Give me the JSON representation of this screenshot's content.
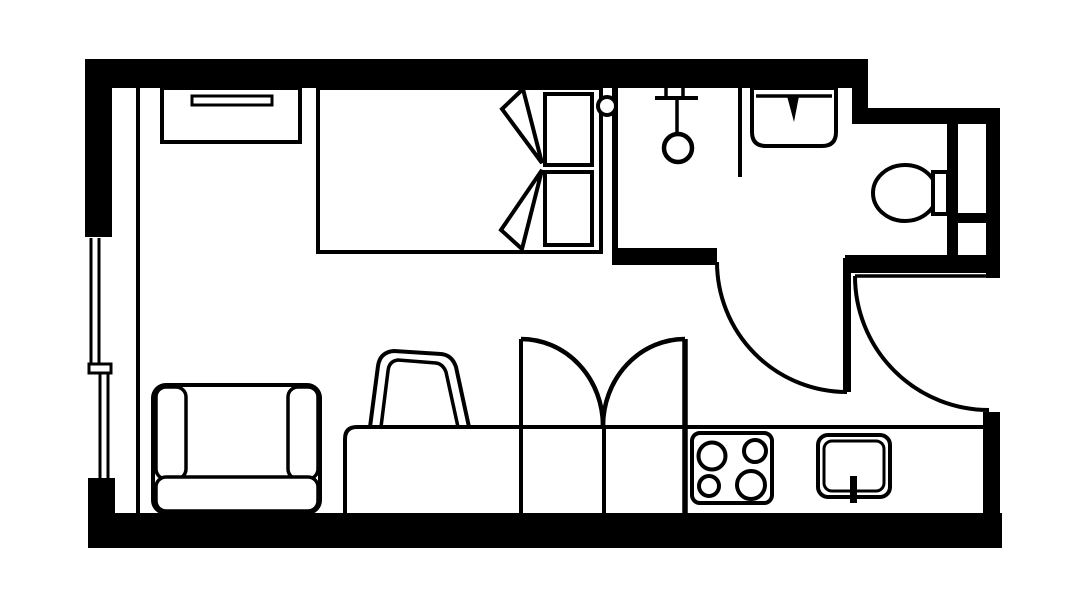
{
  "canvas": {
    "width": 1092,
    "height": 614,
    "viewbox": "0 0 1092 614"
  },
  "colors": {
    "background": "#ffffff",
    "line": "#000000"
  },
  "floor_plan": {
    "kind": "studio-apartment-floor-plan",
    "areas": [
      {
        "name": "sleeping-area",
        "elements": [
          "wardrobe-dresser",
          "dresser-handle",
          "double-bed",
          "pillow",
          "pillow",
          "duvet-fold",
          "duvet-fold",
          "wall-knob"
        ]
      },
      {
        "name": "bathroom",
        "elements": [
          "shower-head",
          "shower-rail",
          "shower-screen",
          "wash-basin",
          "basin-tap",
          "toilet-bowl",
          "toilet-cistern",
          "service-shaft-window",
          "bathroom-door-swing"
        ]
      },
      {
        "name": "living-area",
        "elements": [
          "armchair",
          "tilted-chair",
          "sofa-bench",
          "bench-divider",
          "bench-divider",
          "bench-divider",
          "fold-out-arc",
          "fold-out-arc"
        ]
      },
      {
        "name": "kitchenette",
        "elements": [
          "cooktop-4-burners",
          "kitchen-sink",
          "faucet",
          "counter-edge"
        ]
      },
      {
        "name": "entry",
        "elements": [
          "entry-door-swing",
          "door-leaf"
        ]
      },
      {
        "name": "envelope",
        "elements": [
          "exterior-walls",
          "left-window-double-pane",
          "window-sill-break",
          "interior-wall-line"
        ]
      }
    ]
  }
}
